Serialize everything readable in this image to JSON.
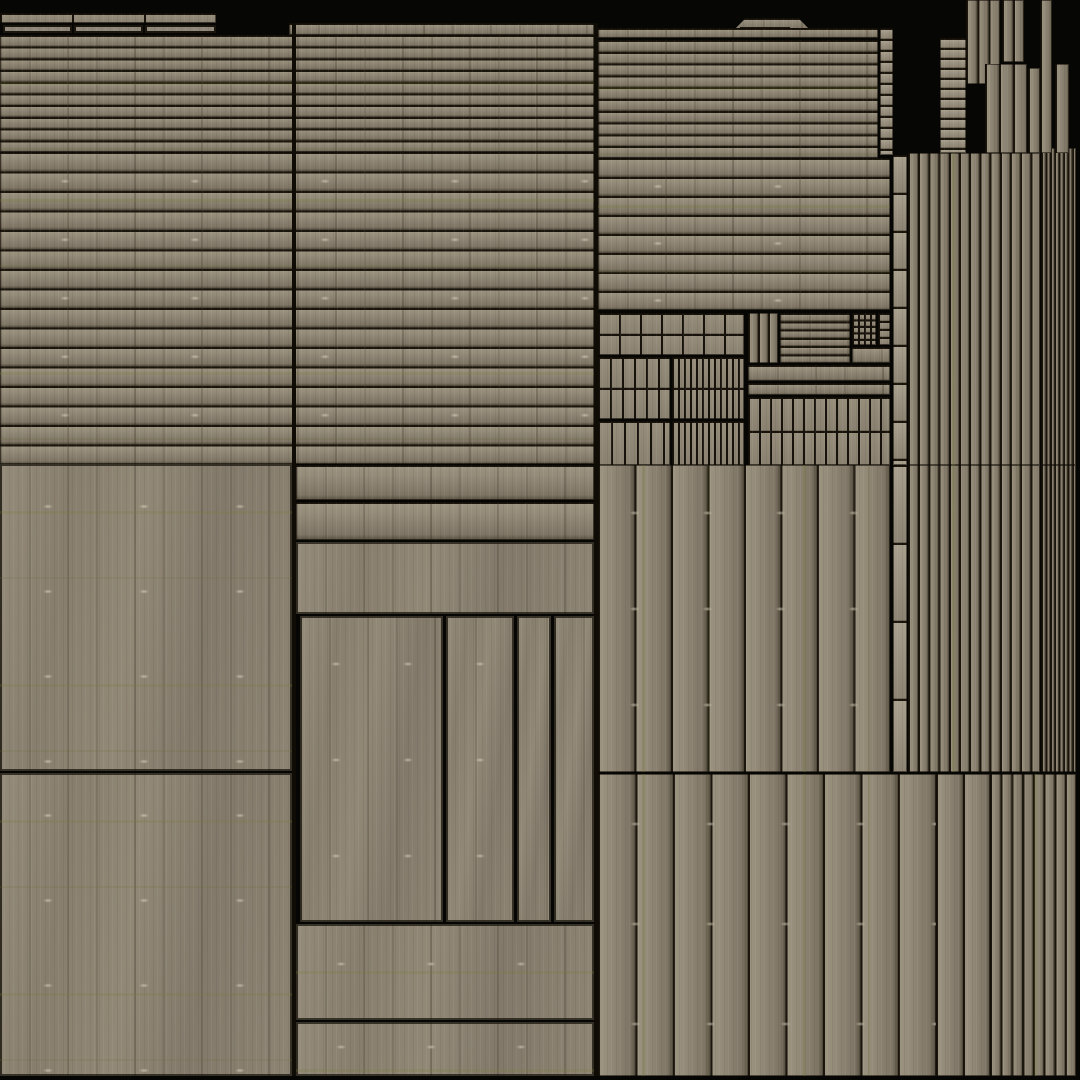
{
  "meta": {
    "kind": "wood-plank-texture-atlas",
    "canvas": {
      "width": 1080,
      "height": 1080
    }
  },
  "palette": {
    "background": "#060604",
    "seam_dark": "#1a150d",
    "wood_light": "#9b927f",
    "wood_mid": "#8b8271",
    "wood_shadow": "#5f5748",
    "moss_green": "#767c3a"
  },
  "atlas": {
    "regions": [
      {
        "n": "strip-top-left-segmented",
        "c": "wood-grid",
        "x": 0,
        "y": 13,
        "w": 216,
        "h": 10,
        "px": 72,
        "py": 10
      },
      {
        "n": "strip-box-1",
        "c": "wood-box",
        "x": 3,
        "y": 25,
        "w": 69,
        "h": 8
      },
      {
        "n": "strip-box-2",
        "c": "wood-box",
        "x": 74,
        "y": 25,
        "w": 69,
        "h": 8
      },
      {
        "n": "strip-box-3",
        "c": "wood-box",
        "x": 145,
        "y": 25,
        "w": 71,
        "h": 8
      },
      {
        "n": "mid-top-cap-row",
        "c": "wood-h",
        "x": 289,
        "y": 23,
        "w": 305,
        "h": 12,
        "p": 12
      },
      {
        "n": "left-mid-thin-plank-rows",
        "c": "wood-h moss-h",
        "x": 0,
        "y": 35,
        "w": 594,
        "h": 117,
        "p": 11.7
      },
      {
        "n": "left-mid-plank-rows",
        "c": "wood-h marks moss-h",
        "x": 0,
        "y": 152,
        "w": 594,
        "h": 312,
        "p": 19.5,
        "mx": 130,
        "my": 58.5
      },
      {
        "n": "left-large-panel-upper",
        "c": "panel marks moss-h",
        "x": 0,
        "y": 464,
        "w": 292,
        "h": 307,
        "mx": 96,
        "my": 85
      },
      {
        "n": "left-large-panel-lower",
        "c": "panel marks moss-h",
        "x": 0,
        "y": 773,
        "w": 292,
        "h": 303,
        "mx": 96,
        "my": 85
      },
      {
        "n": "right-top-tab",
        "c": "wood-h",
        "x": 734,
        "y": 18,
        "w": 76,
        "h": 12,
        "p": 12,
        "clip": "polygon(0 100%, 12px 0, calc(100% - 12px) 0, 100% 100%)"
      },
      {
        "n": "right-top-tab-box",
        "c": "wood-box",
        "x": 740,
        "y": 27,
        "w": 50,
        "h": 9
      },
      {
        "n": "right-cap-row",
        "c": "wood-h",
        "x": 598,
        "y": 28,
        "w": 280,
        "h": 10,
        "p": 10
      },
      {
        "n": "right-thin-plank-rows",
        "c": "wood-h moss-h",
        "x": 598,
        "y": 40,
        "w": 280,
        "h": 118,
        "p": 11.8
      },
      {
        "n": "right-upper-pole",
        "c": "pole",
        "x": 880,
        "y": 28,
        "w": 13,
        "h": 127,
        "p": 11
      },
      {
        "n": "right-plank-rows",
        "c": "wood-h marks moss-h",
        "x": 598,
        "y": 158,
        "w": 292,
        "h": 152,
        "p": 19,
        "mx": 120,
        "my": 57
      },
      {
        "n": "cluster-medium-blocks",
        "c": "wood-grid",
        "x": 598,
        "y": 313,
        "w": 146,
        "h": 42,
        "px": 21,
        "py": 21
      },
      {
        "n": "cluster-small-blocks-left",
        "c": "wood-grid",
        "x": 598,
        "y": 357,
        "w": 72,
        "h": 62,
        "px": 12,
        "py": 31
      },
      {
        "n": "cluster-dense-strips-left",
        "c": "wood-grid",
        "x": 672,
        "y": 357,
        "w": 72,
        "h": 62,
        "px": 6,
        "py": 31
      },
      {
        "n": "cluster-vertical-strips",
        "c": "wood-grid",
        "x": 598,
        "y": 421,
        "w": 72,
        "h": 44,
        "px": 13,
        "py": 44
      },
      {
        "n": "cluster-dense-strips-2",
        "c": "wood-grid",
        "x": 672,
        "y": 421,
        "w": 72,
        "h": 44,
        "px": 6,
        "py": 44
      },
      {
        "n": "shutter-vertical-planks",
        "c": "wood-v",
        "x": 748,
        "y": 313,
        "w": 30,
        "h": 50,
        "p": 10
      },
      {
        "n": "shutter-horizontal-slats",
        "c": "wood-h",
        "x": 780,
        "y": 313,
        "w": 70,
        "h": 50,
        "p": 8.3
      },
      {
        "n": "shutter-tiny-grid",
        "c": "wood-grid",
        "x": 852,
        "y": 313,
        "w": 24,
        "h": 32,
        "px": 6,
        "py": 6.5
      },
      {
        "n": "shutter-side-squares",
        "c": "wood-grid",
        "x": 878,
        "y": 313,
        "w": 12,
        "h": 32,
        "px": 12,
        "py": 8
      },
      {
        "n": "shutter-small-band",
        "c": "wood-h",
        "x": 852,
        "y": 347,
        "w": 38,
        "h": 16,
        "p": 16
      },
      {
        "n": "cluster-band-wide",
        "c": "wood-h",
        "x": 748,
        "y": 365,
        "w": 142,
        "h": 16,
        "p": 16
      },
      {
        "n": "cluster-band-thin",
        "c": "wood-h",
        "x": 748,
        "y": 383,
        "w": 142,
        "h": 12,
        "p": 12
      },
      {
        "n": "cluster-plank-grid",
        "c": "wood-grid",
        "x": 748,
        "y": 397,
        "w": 142,
        "h": 68,
        "px": 11,
        "py": 34
      },
      {
        "n": "mid-band-row-1",
        "c": "wood-h",
        "x": 296,
        "y": 465,
        "w": 298,
        "h": 35,
        "p": 35
      },
      {
        "n": "mid-band-row-2",
        "c": "wood-h",
        "x": 296,
        "y": 502,
        "w": 298,
        "h": 38,
        "p": 38
      },
      {
        "n": "mid-lintel-plank",
        "c": "panel",
        "x": 296,
        "y": 542,
        "w": 298,
        "h": 72
      },
      {
        "n": "door-panel-wide",
        "c": "panel marks",
        "x": 300,
        "y": 616,
        "w": 143,
        "h": 306,
        "mx": 72,
        "my": 96
      },
      {
        "n": "door-panel-middle",
        "c": "panel marks",
        "x": 446,
        "y": 616,
        "w": 68,
        "h": 306,
        "mx": 68,
        "my": 96
      },
      {
        "n": "door-panel-narrow",
        "c": "panel",
        "x": 517,
        "y": 616,
        "w": 34,
        "h": 306
      },
      {
        "n": "door-panel-right",
        "c": "panel",
        "x": 554,
        "y": 616,
        "w": 40,
        "h": 306
      },
      {
        "n": "mid-bottom-panel-upper",
        "c": "panel marks moss-h",
        "x": 296,
        "y": 924,
        "w": 298,
        "h": 96,
        "mx": 90,
        "my": 80
      },
      {
        "n": "mid-bottom-panel-lower",
        "c": "panel marks moss-h",
        "x": 296,
        "y": 1022,
        "w": 298,
        "h": 54,
        "mx": 90,
        "my": 50
      },
      {
        "n": "right-wide-vertical-planks",
        "c": "wood-v marks moss-v",
        "x": 598,
        "y": 465,
        "w": 292,
        "h": 307,
        "p": 36.5,
        "mx": 73,
        "my": 96
      },
      {
        "n": "right-pole-mid",
        "c": "pole",
        "x": 893,
        "y": 155,
        "w": 14,
        "h": 310,
        "p": 38
      },
      {
        "n": "right-pole-lower",
        "c": "pole",
        "x": 893,
        "y": 465,
        "w": 14,
        "h": 307,
        "p": 78
      },
      {
        "n": "narrow-vertical-planks-1",
        "c": "wood-v moss-v",
        "x": 908,
        "y": 153,
        "w": 132,
        "h": 312,
        "p": 10.2
      },
      {
        "n": "ultra-narrow-strips-1",
        "c": "wood-v",
        "x": 1041,
        "y": 148,
        "w": 35,
        "h": 317,
        "p": 4.4
      },
      {
        "n": "narrow-vertical-planks-2",
        "c": "wood-v moss-v",
        "x": 908,
        "y": 465,
        "w": 132,
        "h": 307,
        "p": 10.2
      },
      {
        "n": "ultra-narrow-strips-2",
        "c": "wood-v",
        "x": 1041,
        "y": 465,
        "w": 35,
        "h": 307,
        "p": 4.4
      },
      {
        "n": "bottom-wide-vertical-planks",
        "c": "wood-v marks moss-v",
        "x": 598,
        "y": 774,
        "w": 338,
        "h": 302,
        "p": 37.5,
        "mx": 75,
        "my": 100
      },
      {
        "n": "bottom-medium-vertical-planks",
        "c": "wood-v",
        "x": 936,
        "y": 774,
        "w": 54,
        "h": 302,
        "p": 27
      },
      {
        "n": "bottom-narrow-vertical-strips",
        "c": "wood-v moss-v",
        "x": 990,
        "y": 774,
        "w": 86,
        "h": 302,
        "p": 10.75
      },
      {
        "n": "topright-mini-plank-stack",
        "c": "pole",
        "x": 940,
        "y": 38,
        "w": 26,
        "h": 115,
        "p": 10
      },
      {
        "n": "topright-plank-strip-a",
        "c": "wood-v",
        "x": 966,
        "y": 0,
        "w": 34,
        "h": 84,
        "p": 11.3
      },
      {
        "n": "topright-plank-strip-b",
        "c": "wood-v",
        "x": 1002,
        "y": 0,
        "w": 22,
        "h": 62,
        "p": 11
      },
      {
        "n": "topright-plank-strip-c",
        "c": "wood-v",
        "x": 985,
        "y": 64,
        "w": 42,
        "h": 89,
        "p": 14
      },
      {
        "n": "topright-plank-strip-d",
        "c": "wood-v",
        "x": 1040,
        "y": 0,
        "w": 12,
        "h": 153,
        "p": 12
      },
      {
        "n": "topright-plank-strip-e",
        "c": "wood-v",
        "x": 1055,
        "y": 64,
        "w": 14,
        "h": 89,
        "p": 14
      },
      {
        "n": "topright-plank-strip-f",
        "c": "wood-v",
        "x": 1028,
        "y": 68,
        "w": 12,
        "h": 85,
        "p": 12
      },
      {
        "n": "column-seam-left-mid",
        "c": "seam",
        "x": 292,
        "y": 23,
        "w": 4,
        "h": 1053
      },
      {
        "n": "column-seam-mid-right",
        "c": "seam",
        "x": 594,
        "y": 23,
        "w": 4,
        "h": 1053
      }
    ]
  }
}
